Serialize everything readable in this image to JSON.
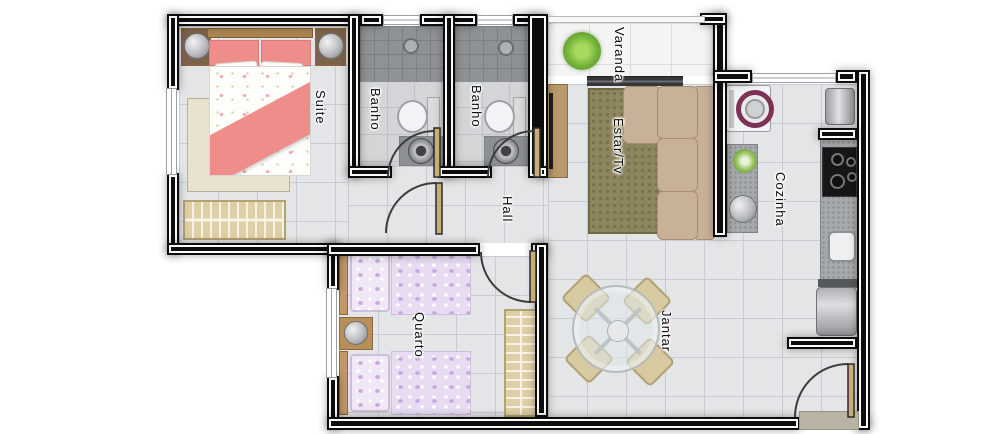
{
  "plan": {
    "type": "apartment-floor-plan",
    "rooms": {
      "suite": {
        "label": "Suite",
        "furniture": [
          "double-bed",
          "nightstand-left",
          "nightstand-right",
          "rug",
          "wardrobe"
        ]
      },
      "banho1": {
        "label": "Banho",
        "furniture": [
          "shower",
          "toilet",
          "washbasin"
        ]
      },
      "banho2": {
        "label": "Banho",
        "furniture": [
          "shower",
          "toilet",
          "washbasin"
        ]
      },
      "varanda": {
        "label": "Varanda",
        "furniture": [
          "plant",
          "sliding-door"
        ]
      },
      "estar": {
        "label": "Estar/Tv",
        "furniture": [
          "tv-rack",
          "corner-sofa",
          "rug"
        ]
      },
      "cozinha": {
        "label": "Cozinha",
        "furniture": [
          "washing-machine",
          "laundry-tank",
          "counter-plant",
          "counter-basin",
          "cooktop",
          "sink",
          "refrigerator"
        ]
      },
      "hall": {
        "label": "Hall",
        "furniture": []
      },
      "quarto": {
        "label": "Quarto",
        "furniture": [
          "single-bed-top",
          "single-bed-bottom",
          "nightstand",
          "wardrobe"
        ]
      },
      "jantar": {
        "label": "Jantar",
        "furniture": [
          "round-glass-table",
          "dining-chairs-x4",
          "entry-door"
        ]
      }
    },
    "colors": {
      "wall": "#0d0d0d",
      "wall_stripe": "#fafafa",
      "floor": "#e4e5e7",
      "floor_line": "#c9cbce",
      "bath_floor": "#d4d5d7",
      "bath_line": "#bfc1c4",
      "shower": "#8f9295",
      "varanda_floor": "#f4f4f4",
      "suite_bed": "#ef8d8a",
      "quarto_bed": "#e7dcf1",
      "quarto_bed_dot": "#c9a8dd",
      "sofa": "#c8b199",
      "sofa_edge": "#a88f74",
      "rug": "#8e865e",
      "suite_rug": "#e9e2cf",
      "wood": "#bd9660",
      "wardrobe": "#ddd0a6",
      "granite": "#a6aaad",
      "washer_ring": "#7d3154",
      "plant": "#76b43c",
      "chair": "#d8caa0",
      "mat": "#b9b3a4",
      "door_arc": "#3c3c3c"
    }
  }
}
